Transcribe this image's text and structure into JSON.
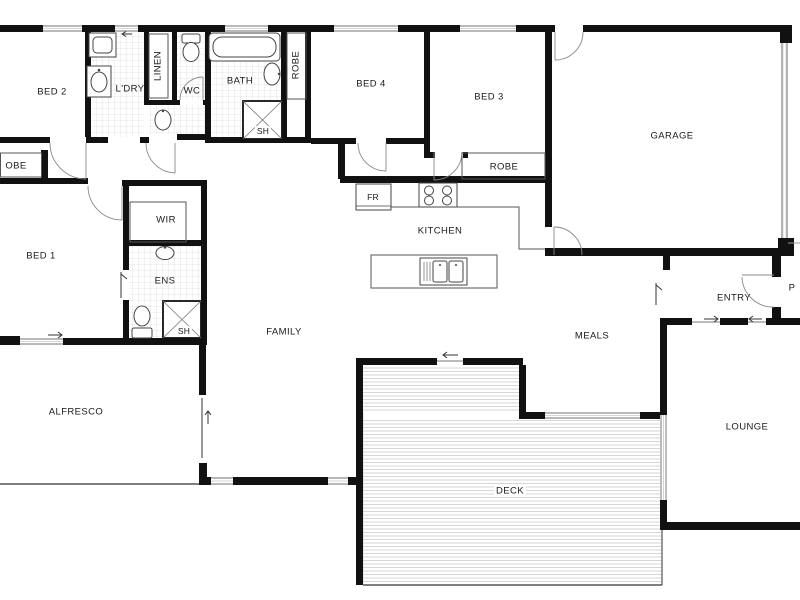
{
  "plan_type": "residential floor plan",
  "rooms": {
    "bed2": "BED 2",
    "ldry": "L'DRY",
    "linen": "LINEN",
    "wc": "WC",
    "bath": "BATH",
    "sh_bath": "SH",
    "robe_bed4": "ROBE",
    "bed4": "BED 4",
    "bed3": "BED 3",
    "garage": "GARAGE",
    "robe_bed3": "ROBE",
    "robe_bed1": "OBE",
    "wir": "WIR",
    "bed1": "BED 1",
    "ens": "ENS",
    "sh_ens": "SH",
    "fridge": "FR",
    "kitchen": "KITCHEN",
    "family": "FAMILY",
    "meals": "MEALS",
    "entry": "ENTRY",
    "porch": "P",
    "alfresco": "ALFRESCO",
    "lounge": "LOUNGE",
    "deck": "DECK"
  },
  "icons": [
    "washing-machine-icon",
    "laundry-trough-icon",
    "toilet-icon",
    "bathtub-icon",
    "basin-icon",
    "shower-icon",
    "cooktop-icon",
    "fridge-icon",
    "island-sink-icon",
    "wardrobe-shelf-icon",
    "door-swing-icon",
    "slide-arrow-icon"
  ],
  "colors": {
    "wall": "#111111",
    "window": "#8f8f8f",
    "tile_grid": "#dcdcdc",
    "deck_boards": "#d2d2d2",
    "text": "#1a1a1a",
    "background": "#ffffff"
  }
}
